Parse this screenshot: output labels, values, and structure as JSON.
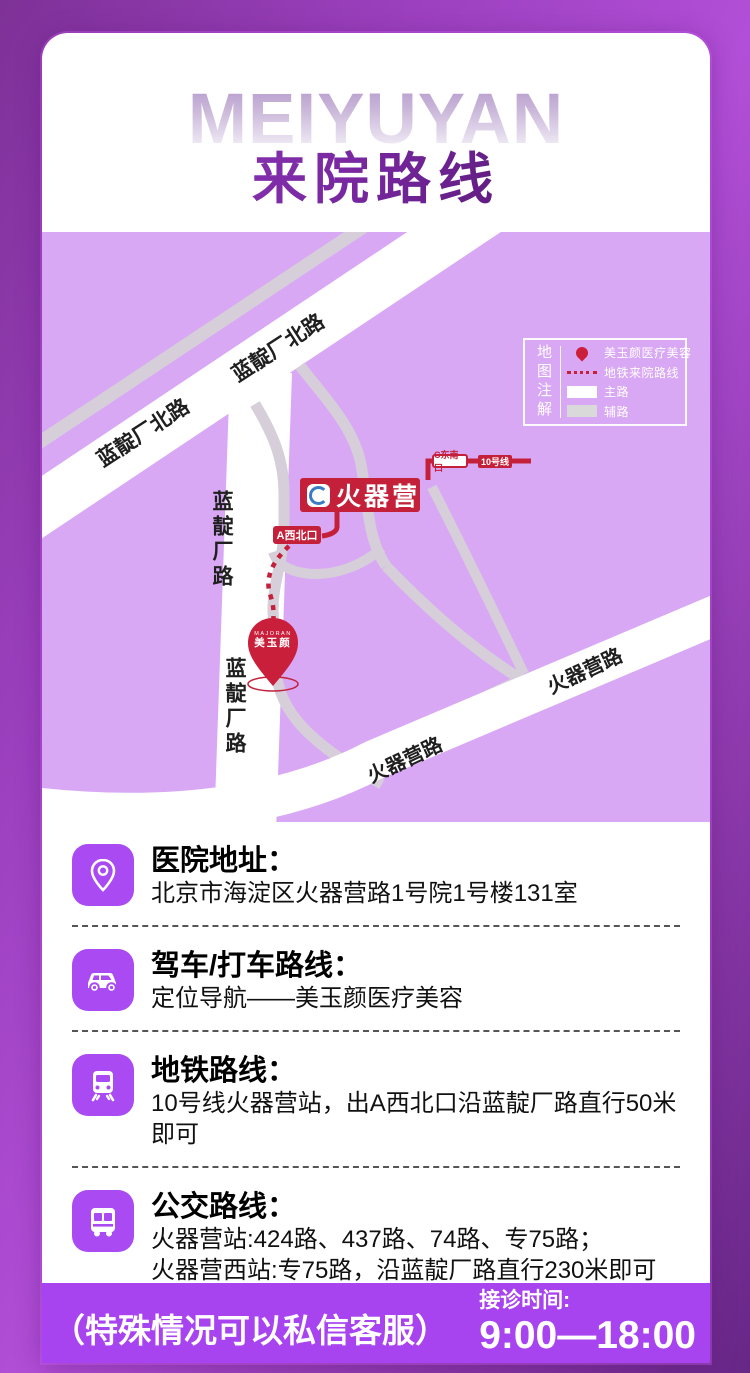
{
  "header": {
    "watermark": "MEIYUYAN",
    "title": "来院路线"
  },
  "map": {
    "legend": {
      "title": "地图注解",
      "items": [
        {
          "swatch": "clinic-pin",
          "label": "美玉颜医疗美容"
        },
        {
          "swatch": "dotted-route",
          "label": "地铁来院路线"
        },
        {
          "swatch": "main-road",
          "label": "主路"
        },
        {
          "swatch": "side-road",
          "label": "辅路"
        }
      ]
    },
    "roads": {
      "landianchang_north": "蓝靛厂北路",
      "landianchang": "蓝靛厂路",
      "huoqiying_road": "火器营路"
    },
    "station": {
      "name": "火器营",
      "line_badge": "10号线",
      "exit_c": "C东南口",
      "exit_a": "A西北口"
    },
    "pin": {
      "brand_en": "MAJORAN",
      "brand_cn": "美玉颜"
    }
  },
  "sections": [
    {
      "icon": "location-pin-icon",
      "title": "医院地址：",
      "line1": "北京市海淀区火器营路1号院1号楼131室",
      "line2": ""
    },
    {
      "icon": "car-icon",
      "title": "驾车/打车路线：",
      "line1": "定位导航——美玉颜医疗美容",
      "line2": ""
    },
    {
      "icon": "train-icon",
      "title": "地铁路线：",
      "line1": "10号线火器营站，出A西北口沿蓝靛厂路直行50米即可",
      "line2": ""
    },
    {
      "icon": "bus-icon",
      "title": "公交路线：",
      "line1": "火器营站:424路、437路、74路、专75路；",
      "line2": "火器营西站:专75路，沿蓝靛厂路直行230米即可"
    }
  ],
  "footer": {
    "note": "（特殊情况可以私信客服）",
    "hours_label": "接诊时间:",
    "hours": "9:00—18:00"
  },
  "colors": {
    "accent_red": "#c4203a",
    "map_bg": "#d9a8f5",
    "tile_purple": "#a94af2",
    "footer_purple": "#a843f0"
  }
}
